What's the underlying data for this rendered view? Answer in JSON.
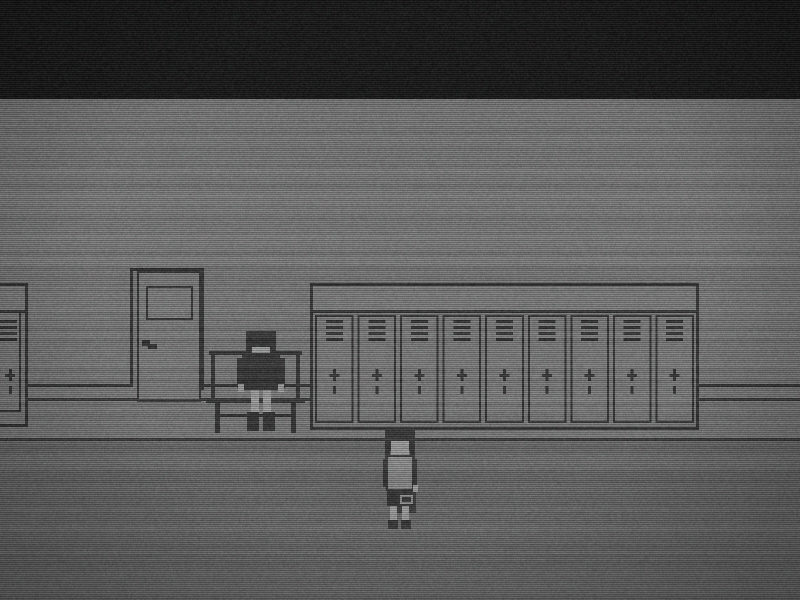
{
  "scene": {
    "description": "Monochrome pixel-art school hallway with VHS static noise",
    "palette": {
      "ceiling": "#0a0a0a",
      "wall": "#7b7b7b",
      "floor": "#646464",
      "outline": "#131313",
      "panel": "#7e7e7e",
      "dark_clothing": "#151515",
      "skin": "#afafaf",
      "shirt": "#919191",
      "bag": "#1d1d1d",
      "bag_highlight": "#9a9a9a"
    },
    "layout": {
      "ceiling_bottom_y": 99,
      "wall_rail_upper_y": 384,
      "wall_rail_lower_y": 398,
      "floor_line_y": 438
    },
    "entities": {
      "left_locker": {
        "label": "partial locker unit at left edge",
        "doors_visible": 1
      },
      "door": {
        "label": "hallway door with small window and handle"
      },
      "bench": {
        "label": "bench with backrest"
      },
      "sitting_character": {
        "label": "dark-haired figure sitting on bench"
      },
      "locker_row": {
        "label": "row of school lockers",
        "door_count": 9,
        "vent_slats_per_door": 4
      },
      "standing_character": {
        "label": "dark-haired figure standing holding a bag"
      }
    }
  }
}
